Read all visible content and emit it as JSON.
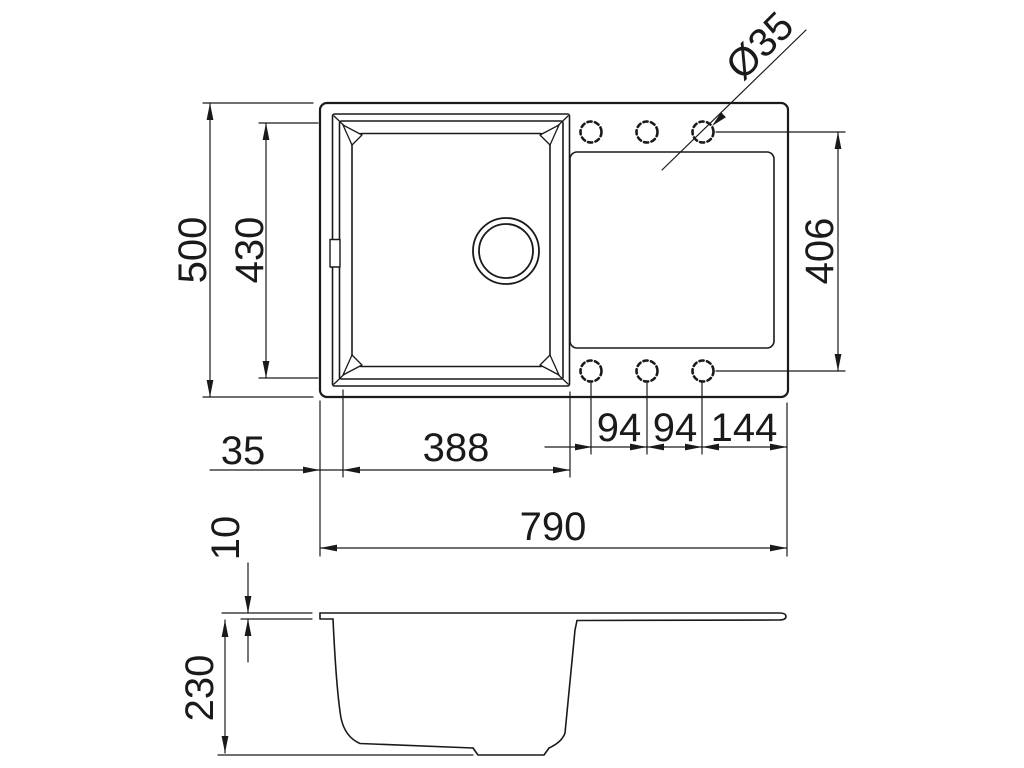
{
  "drawing": {
    "background": "#ffffff",
    "line_color": "#1a1a1a",
    "views": {
      "plan": "top view of sink with bowl, drainboard and six tap holes",
      "side": "side section profile of sink"
    },
    "labels": {
      "overall_depth": "500",
      "bowl_depth": "430",
      "hole_field_depth": "406",
      "hole_diameter": "Ø35",
      "left_offset": "35",
      "bowl_width": "388",
      "hole_pitch_1": "94",
      "hole_pitch_2": "94",
      "hole_pitch_3": "144",
      "overall_width": "790",
      "rim_thickness": "10",
      "bowl_height": "230"
    }
  }
}
